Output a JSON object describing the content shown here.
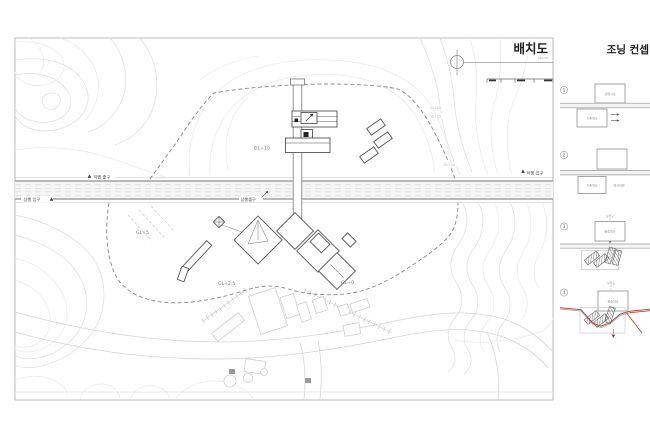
{
  "plan": {
    "title": "배치도",
    "title_note": "GL+15",
    "levels": {
      "gl10_main": "GL+10",
      "gl5": "GL+5",
      "gl2_5": "GL+2.5",
      "gl0": "GL+0",
      "contour_gl20": "GL+20",
      "contour_gl15": "GL+15",
      "contour_gl10": "GL+10"
    },
    "gates": {
      "down_exit": "하행 출구",
      "up_entry": "상행 입구",
      "up_exit": "상행출구",
      "down_entry": "하행 입구"
    }
  },
  "zoning": {
    "title": "조닝 컨셉",
    "steps": [
      {
        "num": "1",
        "top_box": "상업시설",
        "bottom_box": "기존역사"
      },
      {
        "num": "2",
        "top_box": "",
        "bottom_box": "기존역사",
        "side_label": "역사이전"
      },
      {
        "num": "3",
        "peak_label": "보행교",
        "top_box": "환승역사"
      },
      {
        "num": "4",
        "peak_label": "보행교",
        "top_box": "환승역사"
      }
    ]
  },
  "colors": {
    "accent_red": "#c0392b",
    "line_gray": "#9a9a9a"
  }
}
